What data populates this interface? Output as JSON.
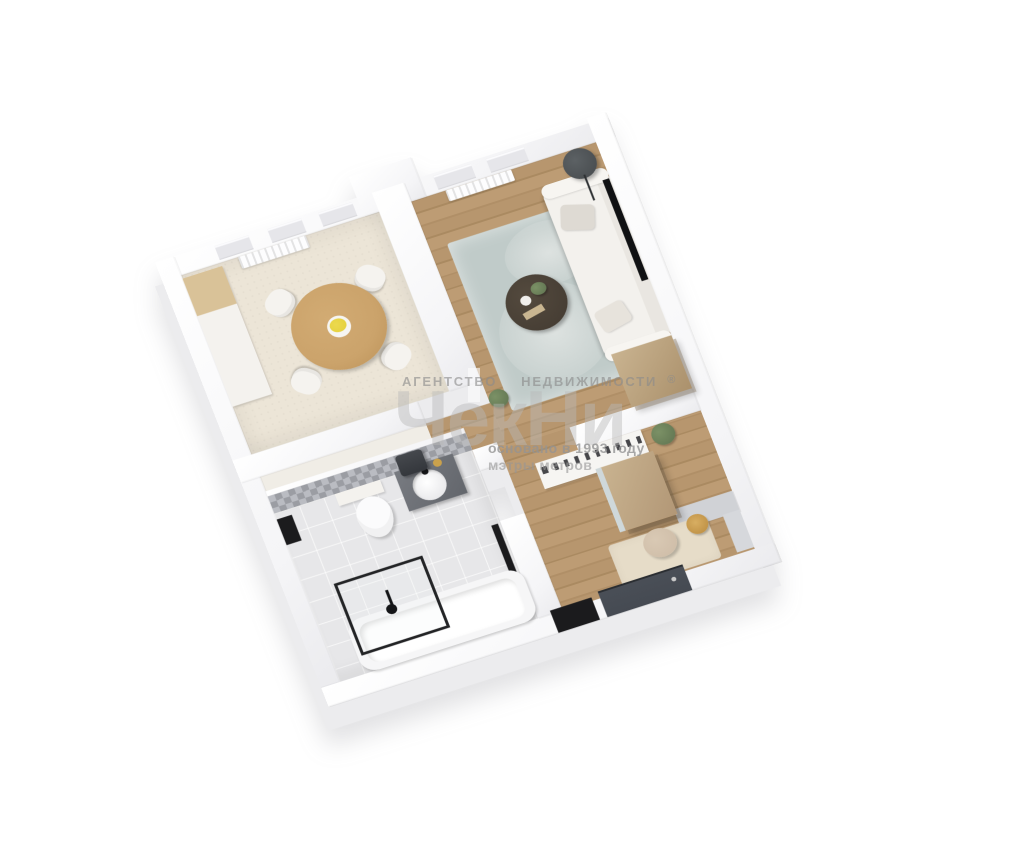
{
  "watermark": {
    "agency_word1": "АГЕНТСТВО",
    "agency_word2": "НЕДВИЖИМОСТИ",
    "registered_mark": "®",
    "logo_text": "ЧекНи",
    "founded_line": "основано в 1993 году",
    "slogan_line": "мэтры метров"
  },
  "colors": {
    "background": "#ffffff",
    "wall_top": "#fbfbfc",
    "wall_side": "#ececee",
    "wood_floor": "#b7966e",
    "wood_floor_dark": "#aa8a61",
    "kitchen_floor": "#ece5d7",
    "bath_floor": "#e7e7e9",
    "tile_dark": "#9b9da3",
    "tile_light": "#babcc2",
    "rug": "#c0cbc9",
    "rug_light": "#dde2e0",
    "sofa": "#f3f1ed",
    "dining_table_wood": "#cba36b",
    "cabinet_wood": "#c9b390",
    "cabinet_wood_dark": "#ab916c",
    "coffee_table": "#423a31",
    "door_dark": "#454a52",
    "black": "#1b1b1d",
    "plant_green": "#5f7350",
    "gold": "#b98a3e",
    "flower_yellow": "#e3cf3a",
    "watermark_gray": "#aaaaaa"
  }
}
